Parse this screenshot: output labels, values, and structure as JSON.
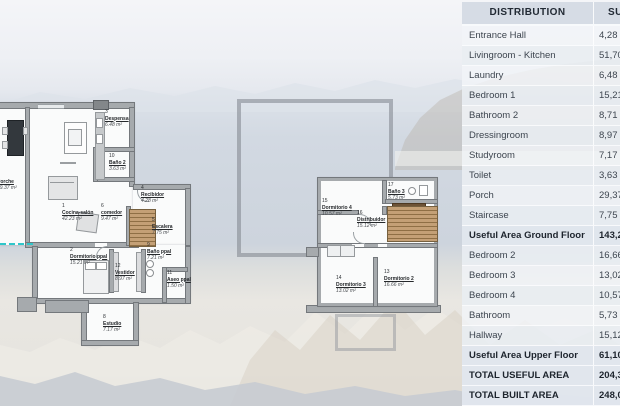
{
  "table": {
    "header": {
      "distribution": "DISTRIBUTION",
      "surface": "SURFACE"
    },
    "rows": [
      {
        "label": "Entrance Hall",
        "value": "4,28",
        "emphasis": false
      },
      {
        "label": "Livingroom - Kitchen",
        "value": "51,70",
        "emphasis": false
      },
      {
        "label": "Laundry",
        "value": "6,48",
        "emphasis": false
      },
      {
        "label": "Bedroom 1",
        "value": "15,21",
        "emphasis": false
      },
      {
        "label": "Bathroom 2",
        "value": "8,71",
        "emphasis": false
      },
      {
        "label": "Dressingroom",
        "value": "8,97",
        "emphasis": false
      },
      {
        "label": "Studyroom",
        "value": "7,17",
        "emphasis": false
      },
      {
        "label": "Toilet",
        "value": "3,63",
        "emphasis": false
      },
      {
        "label": "Porch",
        "value": "29,37",
        "emphasis": false
      },
      {
        "label": "Staircase",
        "value": "7,75",
        "emphasis": false
      },
      {
        "label": "Useful Area Ground Floor",
        "value": "143,27",
        "emphasis": true
      },
      {
        "label": "Bedroom 2",
        "value": "16,66",
        "emphasis": false
      },
      {
        "label": "Bedroom 3",
        "value": "13,02",
        "emphasis": false
      },
      {
        "label": "Bedroom 4",
        "value": "10,57",
        "emphasis": false
      },
      {
        "label": "Bathroom",
        "value": "5,73",
        "emphasis": false
      },
      {
        "label": "Hallway",
        "value": "15,12",
        "emphasis": false
      },
      {
        "label": "Useful Area Upper Floor",
        "value": "61,10",
        "emphasis": true
      },
      {
        "label": "TOTAL USEFUL AREA",
        "value": "204,37",
        "emphasis": true
      },
      {
        "label": "TOTAL BUILT AREA",
        "value": "248,08",
        "emphasis": true
      }
    ]
  },
  "ground_floor": {
    "rooms": {
      "cocina": {
        "num": "1",
        "name": "Cocina-salón",
        "area": "42.23 m²"
      },
      "dormitorio_ppal": {
        "num": "2",
        "name": "Dormitorio ppal",
        "area": "15.21 m²"
      },
      "despensa": {
        "num": "3",
        "name": "Despensa",
        "area": "6.48 m²"
      },
      "recibidor": {
        "num": "4",
        "name": "Recibidor",
        "area": "4.28 m²"
      },
      "escalera": {
        "num": "5",
        "name": "Escalera",
        "area": "7.75 m²"
      },
      "comedor": {
        "num": "6",
        "name": "comedor",
        "area": "9.47 m²"
      },
      "porche": {
        "num": "7",
        "name": "Porche",
        "area": "29.37 m²"
      },
      "estudio": {
        "num": "8",
        "name": "Estudio",
        "area": "7.17 m²"
      },
      "bano_ppal": {
        "num": "9",
        "name": "Baño ppal",
        "area": "7.21 m²"
      },
      "bano2": {
        "num": "10",
        "name": "Baño 2",
        "area": "3.63 m²"
      },
      "aseo_ppal": {
        "num": "11",
        "name": "Aseo ppal",
        "area": "1.50 m²"
      },
      "vestidor": {
        "num": "12",
        "name": "Vestidor",
        "area": "8.97 m²"
      }
    }
  },
  "upper_floor": {
    "rooms": {
      "dormitorio2": {
        "num": "13",
        "name": "Dormitorio 2",
        "area": "16.66 m²"
      },
      "dormitorio3": {
        "num": "14",
        "name": "Dormitorio 3",
        "area": "13.02 m²"
      },
      "dormitorio4": {
        "num": "15",
        "name": "Dormitorio 4",
        "area": "10.57 m²"
      },
      "distribuidor": {
        "num": "16",
        "name": "Distribuidor",
        "area": "15.12 m²"
      },
      "bano3": {
        "num": "17",
        "name": "Baño 3",
        "area": "5.73 m²"
      }
    }
  },
  "colors": {
    "accent_boundary_teal": "#2fc6ca",
    "wall_gray": "#a6aaad",
    "stair_wood": "#c4a076",
    "table_header_bg": "#d5dbe4"
  }
}
